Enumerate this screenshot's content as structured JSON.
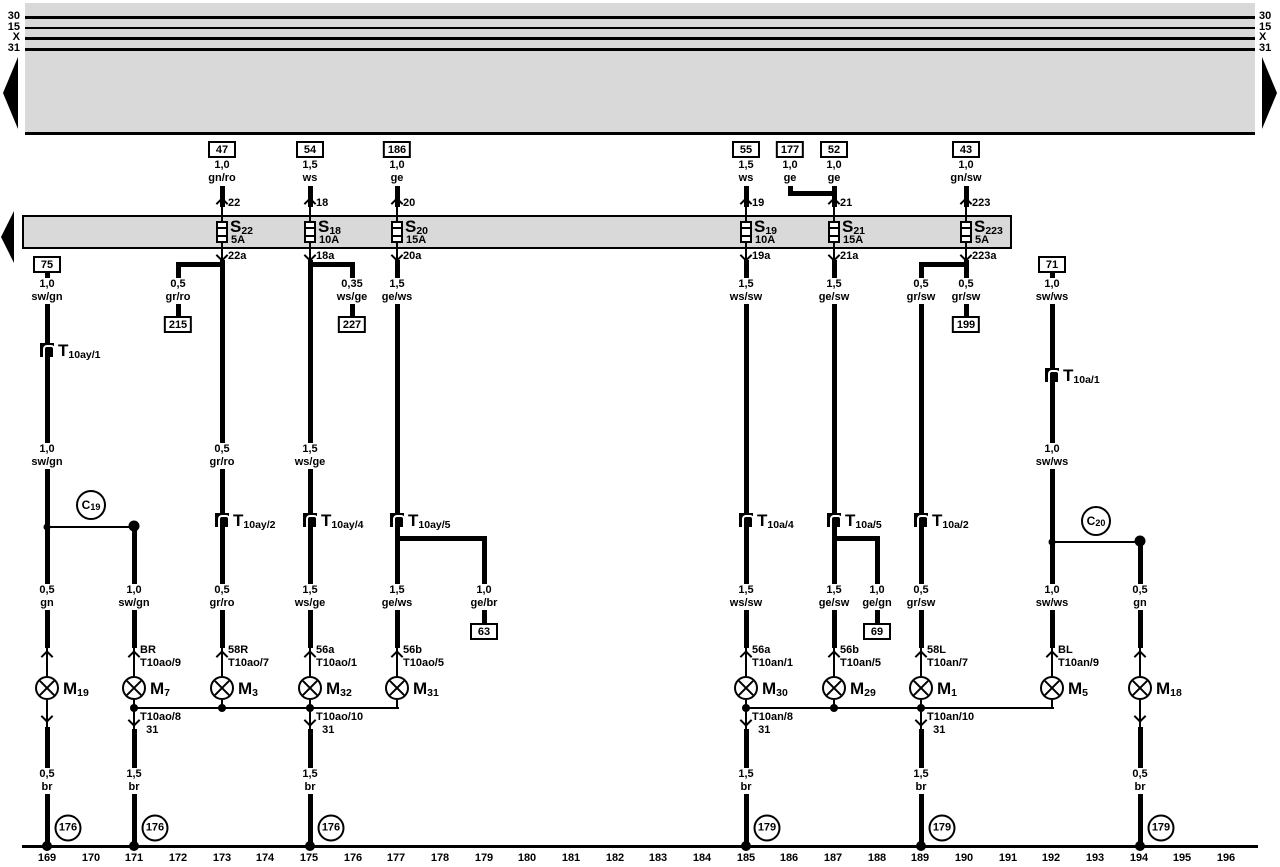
{
  "labels": {
    "fuse_prefix": "S",
    "conn_prefix": "T",
    "bulb_prefix": "M",
    "circle_prefix": "C"
  },
  "bus_left": [
    "30",
    "15",
    "X",
    "31"
  ],
  "bus_right": [
    "30",
    "15",
    "X",
    "31"
  ],
  "top": [
    {
      "box": "47",
      "wire": "1,0\ngn/ro"
    },
    {
      "box": "54",
      "wire": "1,5\nws"
    },
    {
      "box": "186",
      "wire": "1,0\nge"
    },
    {
      "box": "55",
      "wire": "1,5\nws"
    },
    {
      "box": "177",
      "wire": "1,0\nge"
    },
    {
      "box": "52",
      "wire": "1,0\nge"
    },
    {
      "box": "43",
      "wire": "1,0\ngn/sw"
    }
  ],
  "fuses": [
    {
      "sub": "22",
      "amp": "5A",
      "t": "22",
      "b": "22a"
    },
    {
      "sub": "18",
      "amp": "10A",
      "t": "18",
      "b": "18a"
    },
    {
      "sub": "20",
      "amp": "15A",
      "t": "20",
      "b": "20a"
    },
    {
      "sub": "19",
      "amp": "10A",
      "t": "19",
      "b": "19a"
    },
    {
      "sub": "21",
      "amp": "15A",
      "t": "21",
      "b": "21a"
    },
    {
      "sub": "223",
      "amp": "5A",
      "t": "223",
      "b": "223a"
    }
  ],
  "boxes": {
    "b75": "75",
    "b71": "71",
    "b215": "215",
    "b227": "227",
    "b199": "199",
    "b63": "63",
    "b69": "69"
  },
  "wires": {
    "l47a": "1,0\nsw/gn",
    "l47b": "1,0\nsw/gn",
    "l47c": "0,5\ngn",
    "l47d": "0,5\nbr",
    "l134a": "1,0\nsw/gn",
    "l134b": "1,5\nbr",
    "l215": "0,5\ngr/ro",
    "l227": "0,35\nws/ge",
    "l222a": "0,5\ngr/ro",
    "l222b": "0,5\ngr/ro",
    "l310a": "1,5\nws/ge",
    "l310b": "1,5\nws/ge",
    "l310c": "1,5\nbr",
    "l397a": "1,5\nge/ws",
    "l397b": "1,5\nge/ws",
    "l484": "1,0\nge/br",
    "l746a": "1,5\nws/sw",
    "l746b": "1,5\nws/sw",
    "l746c": "1,5\nbr",
    "l834a": "1,5\nge/sw",
    "l834b": "1,5\nge/sw",
    "l877": "1,0\nge/gn",
    "l921a": "0,5\ngr/sw",
    "l921b": "0,5\ngr/sw",
    "l921c": "1,5\nbr",
    "l966": "0,5\ngr/sw",
    "l1052a": "1,0\nsw/ws",
    "l1052b": "1,0\nsw/ws",
    "l1052c": "1,0\nsw/ws",
    "l1140a": "0,5\ngn",
    "l1140b": "0,5\nbr"
  },
  "tconn": {
    "t1": "10ay/1",
    "t2": "10ay/2",
    "t4": "10ay/4",
    "t5": "10ay/5",
    "a4": "10a/4",
    "a5": "10a/5",
    "a2": "10a/2",
    "a1": "10a/1"
  },
  "circles": {
    "c19": "19",
    "c20": "20"
  },
  "tags": {
    "m7": "BR\nT10ao/9",
    "m3": "58R\nT10ao/7",
    "m32": "56a\nT10ao/1",
    "m31": "56b\nT10ao/5",
    "m30": "56a\nT10an/1",
    "m29": "56b\nT10an/5",
    "m1": "58L\nT10an/7",
    "m5": "BL\nT10an/9",
    "g134": "T10ao/8\n  31",
    "g310": "T10ao/10\n  31",
    "g746": "T10an/8\n  31",
    "g921": "T10an/10\n  31"
  },
  "bulbs": [
    "19",
    "7",
    "3",
    "32",
    "31",
    "30",
    "29",
    "1",
    "5",
    "18"
  ],
  "grounds": [
    "176",
    "176",
    "176",
    "179",
    "179",
    "179"
  ],
  "scale": [
    "169",
    "170",
    "171",
    "172",
    "173",
    "174",
    "175",
    "176",
    "177",
    "178",
    "179",
    "180",
    "181",
    "182",
    "183",
    "184",
    "185",
    "186",
    "187",
    "188",
    "189",
    "190",
    "191",
    "192",
    "193",
    "194",
    "195",
    "196"
  ]
}
